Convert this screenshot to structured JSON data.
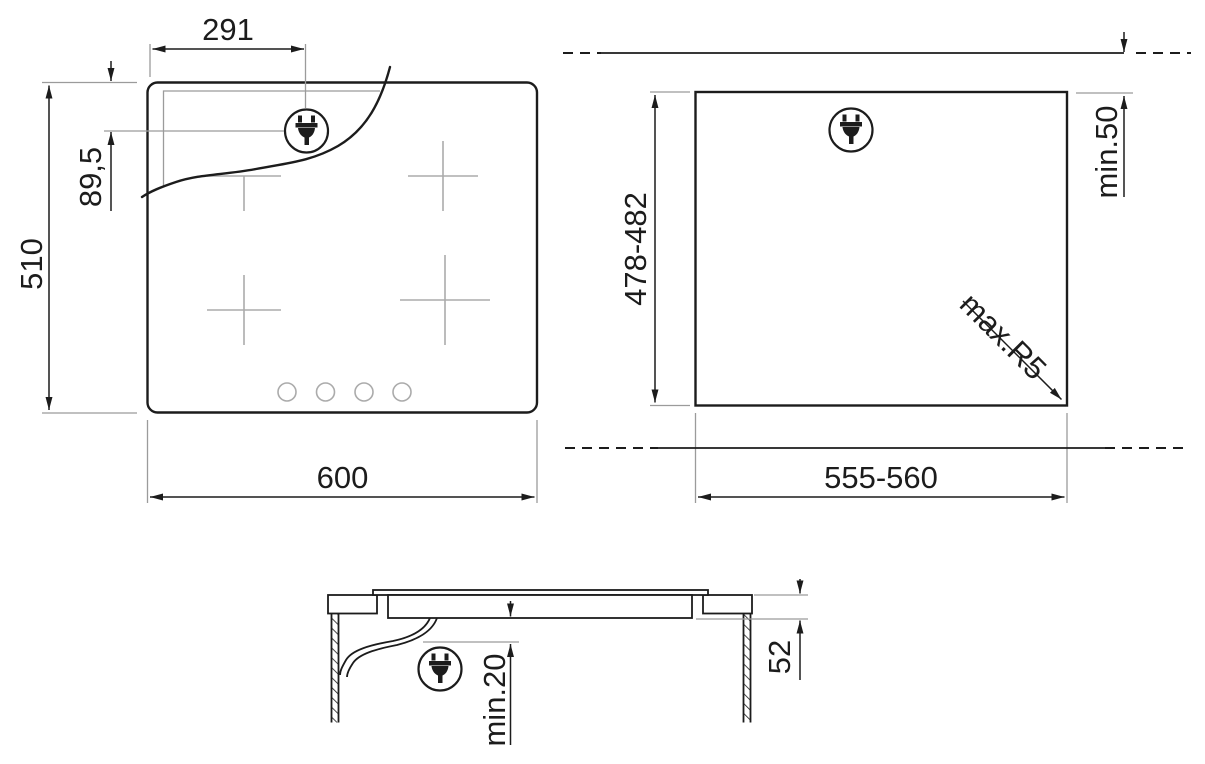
{
  "title": "Hob installation dimensions drawing",
  "labels": {
    "plug_offset_x": "291",
    "plug_offset_y": "89,5",
    "hob_depth": "510",
    "hob_width": "600",
    "cutout_depth": "478-482",
    "wall_clearance": "min.50",
    "corner_radius": "max.R5",
    "cutout_width": "555-560",
    "hob_height": "52",
    "bottom_clearance": "min.20"
  },
  "icons": {
    "plug": "power-plug-icon"
  },
  "views": {
    "top_view": "hob top view",
    "cutout_view": "worktop cutout view",
    "section_view": "installation section view"
  },
  "colors": {
    "line": "#1c1c1c",
    "extension_line": "#9b9b9b",
    "burner_marks": "#ababab",
    "background": "#ffffff"
  }
}
